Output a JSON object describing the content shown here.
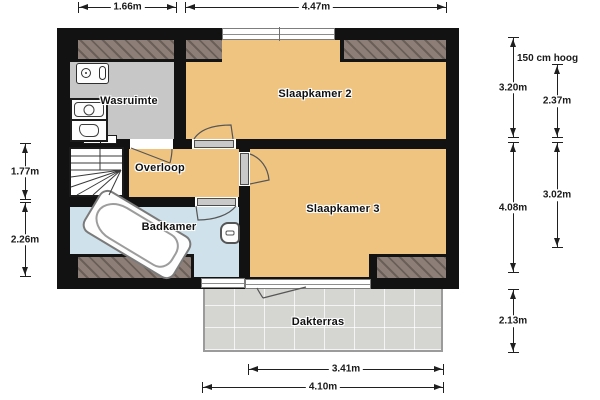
{
  "plan": {
    "title": "floor-plan-upper-storey",
    "rooms": [
      {
        "name": "wasruimte",
        "label": "Wasruimte"
      },
      {
        "name": "slaapkamer-2",
        "label": "Slaapkamer 2"
      },
      {
        "name": "overloop",
        "label": "Overloop"
      },
      {
        "name": "badkamer",
        "label": "Badkamer"
      },
      {
        "name": "slaapkamer-3",
        "label": "Slaapkamer 3"
      },
      {
        "name": "dakterras",
        "label": "Dakterras"
      }
    ],
    "dimensions": {
      "top": [
        "1.66m",
        "4.47m"
      ],
      "left": [
        "1.77m",
        "2.26m"
      ],
      "right": [
        "3.20m",
        "2.37m",
        "4.08m",
        "3.02m",
        "2.13m"
      ],
      "right_note": "150 cm hoog",
      "bottom": [
        "3.41m",
        "4.10m"
      ]
    },
    "fixtures": [
      "bathtub-icon",
      "toilet-icon",
      "washing-machine-icon",
      "dryer-icon",
      "boiler-icon",
      "stairs-icon"
    ],
    "colors": {
      "room_fill": "#EFC481",
      "laundry_fill": "#C7C7C7",
      "bathroom_fill": "#CFE1EA",
      "terrace_fill": "#D5D5D2",
      "sloped_area_fill": "#8D7F78",
      "wall": "#121212"
    }
  }
}
